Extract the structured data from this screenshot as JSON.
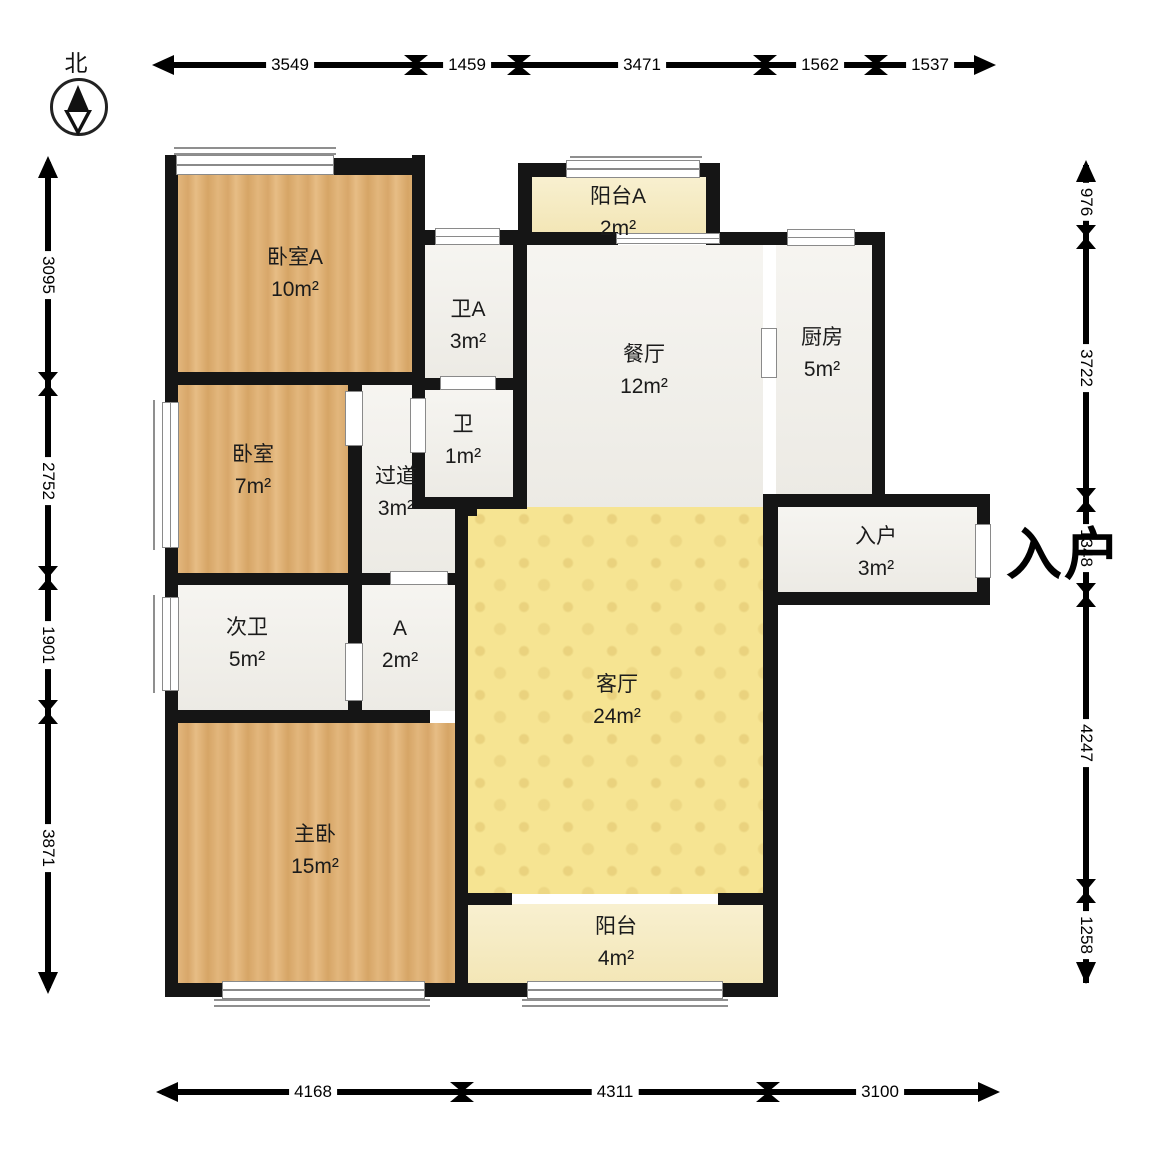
{
  "compass": {
    "label": "北"
  },
  "entry": {
    "callout": "入户"
  },
  "rooms": [
    {
      "name": "卧室A",
      "area": "10m²"
    },
    {
      "name": "卫A",
      "area": "3m²"
    },
    {
      "name": "阳台A",
      "area": "2m²"
    },
    {
      "name": "餐厅",
      "area": "12m²"
    },
    {
      "name": "厨房",
      "area": "5m²"
    },
    {
      "name": "卧室",
      "area": "7m²"
    },
    {
      "name": "卫",
      "area": "1m²"
    },
    {
      "name": "过道",
      "area": "3m²"
    },
    {
      "name": "入户",
      "area": "3m²"
    },
    {
      "name": "次卫",
      "area": "5m²"
    },
    {
      "name": "A",
      "area": "2m²"
    },
    {
      "name": "主卧",
      "area": "15m²"
    },
    {
      "name": "客厅",
      "area": "24m²"
    },
    {
      "name": "阳台",
      "area": "4m²"
    }
  ],
  "dims": {
    "top": [
      "3549",
      "1459",
      "3471",
      "1562",
      "1537"
    ],
    "bottom": [
      "4168",
      "4311",
      "3100"
    ],
    "left": [
      "3095",
      "2752",
      "1901",
      "3871"
    ],
    "right": [
      "976",
      "3722",
      "1348",
      "4247",
      "1258"
    ]
  },
  "colors": {
    "wall": "#151515",
    "wood_floor": "#ddae72",
    "living_room": "#f6e492",
    "balcony": "#f6ecc6",
    "tile": "#f1efe9"
  }
}
